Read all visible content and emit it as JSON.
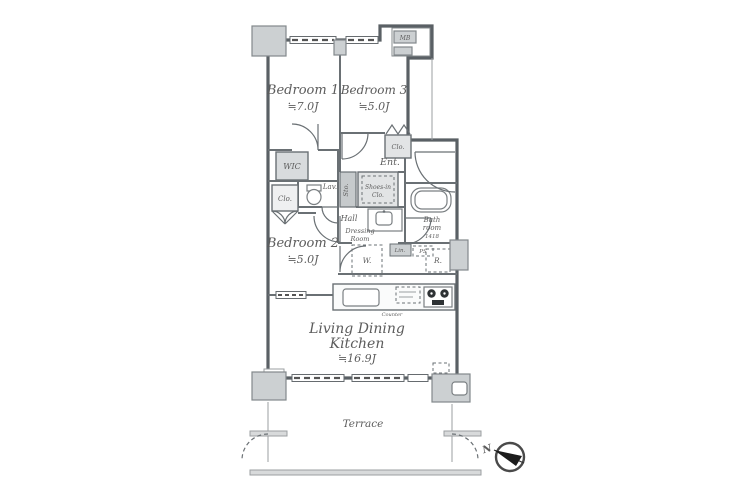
{
  "plan": {
    "bedroom1": {
      "name": "Bedroom 1",
      "size": "≒7.0J"
    },
    "bedroom3": {
      "name": "Bedroom 3",
      "size": "≒5.0J"
    },
    "bedroom2": {
      "name": "Bedroom 2",
      "size": "≒5.0J"
    },
    "ldk": {
      "line1": "Living Dining",
      "line2": "Kitchen",
      "size": "≒16.9J"
    },
    "terrace": "Terrace",
    "wic": "WIC",
    "clo_left": "Clo.",
    "clo_bedroom3": "Clo.",
    "lav": "Lav.",
    "hall": "Hall",
    "sto": "Sto.",
    "shoes_in": {
      "line1": "Shoes-in",
      "line2": "Clo."
    },
    "ent": "Ent.",
    "bath": {
      "line1": "Bath",
      "line2": "room",
      "line3": "1418"
    },
    "dressing": {
      "line1": "Dressing",
      "line2": "Room"
    },
    "lin": "Lin.",
    "ps": "PS",
    "washer": "W.",
    "fridge": "R.",
    "counter": "Counter",
    "mb": "MB",
    "north": "N"
  },
  "colors": {
    "wall": "#5a6065",
    "room": "#eff0f1",
    "pillar": "#ccd0d2",
    "text": "#5c5c5c"
  }
}
